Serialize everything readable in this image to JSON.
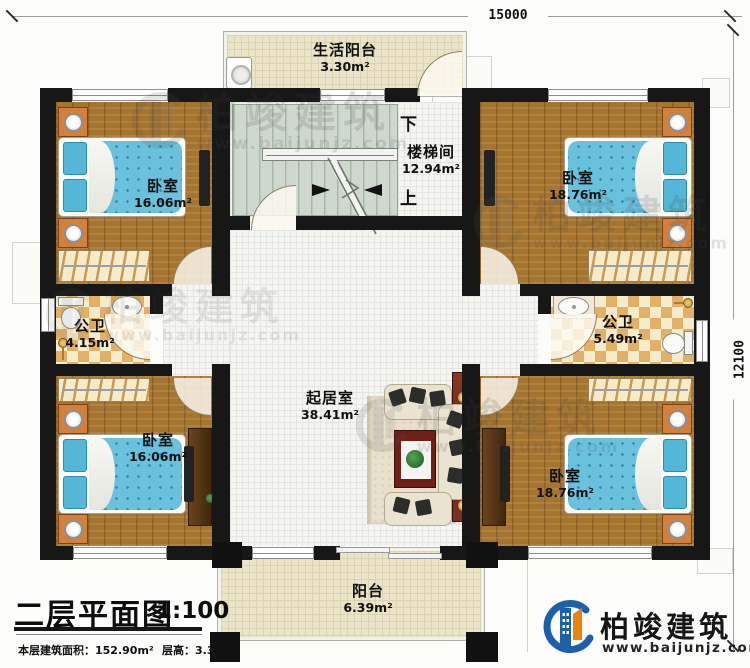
{
  "dimensions": {
    "width_mm": "15000",
    "height_mm": "12100"
  },
  "rooms": {
    "life_balcony": {
      "name": "生活阳台",
      "area": "3.30m²"
    },
    "stairwell": {
      "name": "楼梯间",
      "area": "12.94m²",
      "down_label": "下",
      "up_label": "上"
    },
    "bedroom_top_left": {
      "name": "卧室",
      "area": "16.06m²"
    },
    "bedroom_top_right": {
      "name": "卧室",
      "area": "18.76m²"
    },
    "bathroom_left": {
      "name": "公卫",
      "area": "4.15m²"
    },
    "bathroom_right": {
      "name": "公卫",
      "area": "5.49m²"
    },
    "living_room": {
      "name": "起居室",
      "area": "38.41m²"
    },
    "bedroom_bottom_left": {
      "name": "卧室",
      "area": "16.06m²"
    },
    "bedroom_bottom_right": {
      "name": "卧室",
      "area": "18.76m²"
    },
    "balcony": {
      "name": "阳台",
      "area": "6.39m²"
    }
  },
  "title_block": {
    "title": "二层平面图",
    "scale": "1:100",
    "area_line": "本层建筑面积：152.90m²",
    "height_line": "层高：3.3m"
  },
  "brand": {
    "name": "柏竣建筑",
    "website": "www.baijunjz.com"
  },
  "watermark": {
    "name": "柏竣建筑",
    "website": "www.baijunjz.com"
  },
  "colors": {
    "wall": "#171717",
    "wood_floor": "#a5742f",
    "cream_tile": "#ebe4c8",
    "white_tile": "#f5f5f2",
    "bath_checker": "#e2b167",
    "stair": "#cfd8ce",
    "bed_blue": "#69c1dd",
    "nightstand": "#d2813c",
    "brand_blue": "#1d5fa9",
    "brand_orange": "#e8830d"
  }
}
